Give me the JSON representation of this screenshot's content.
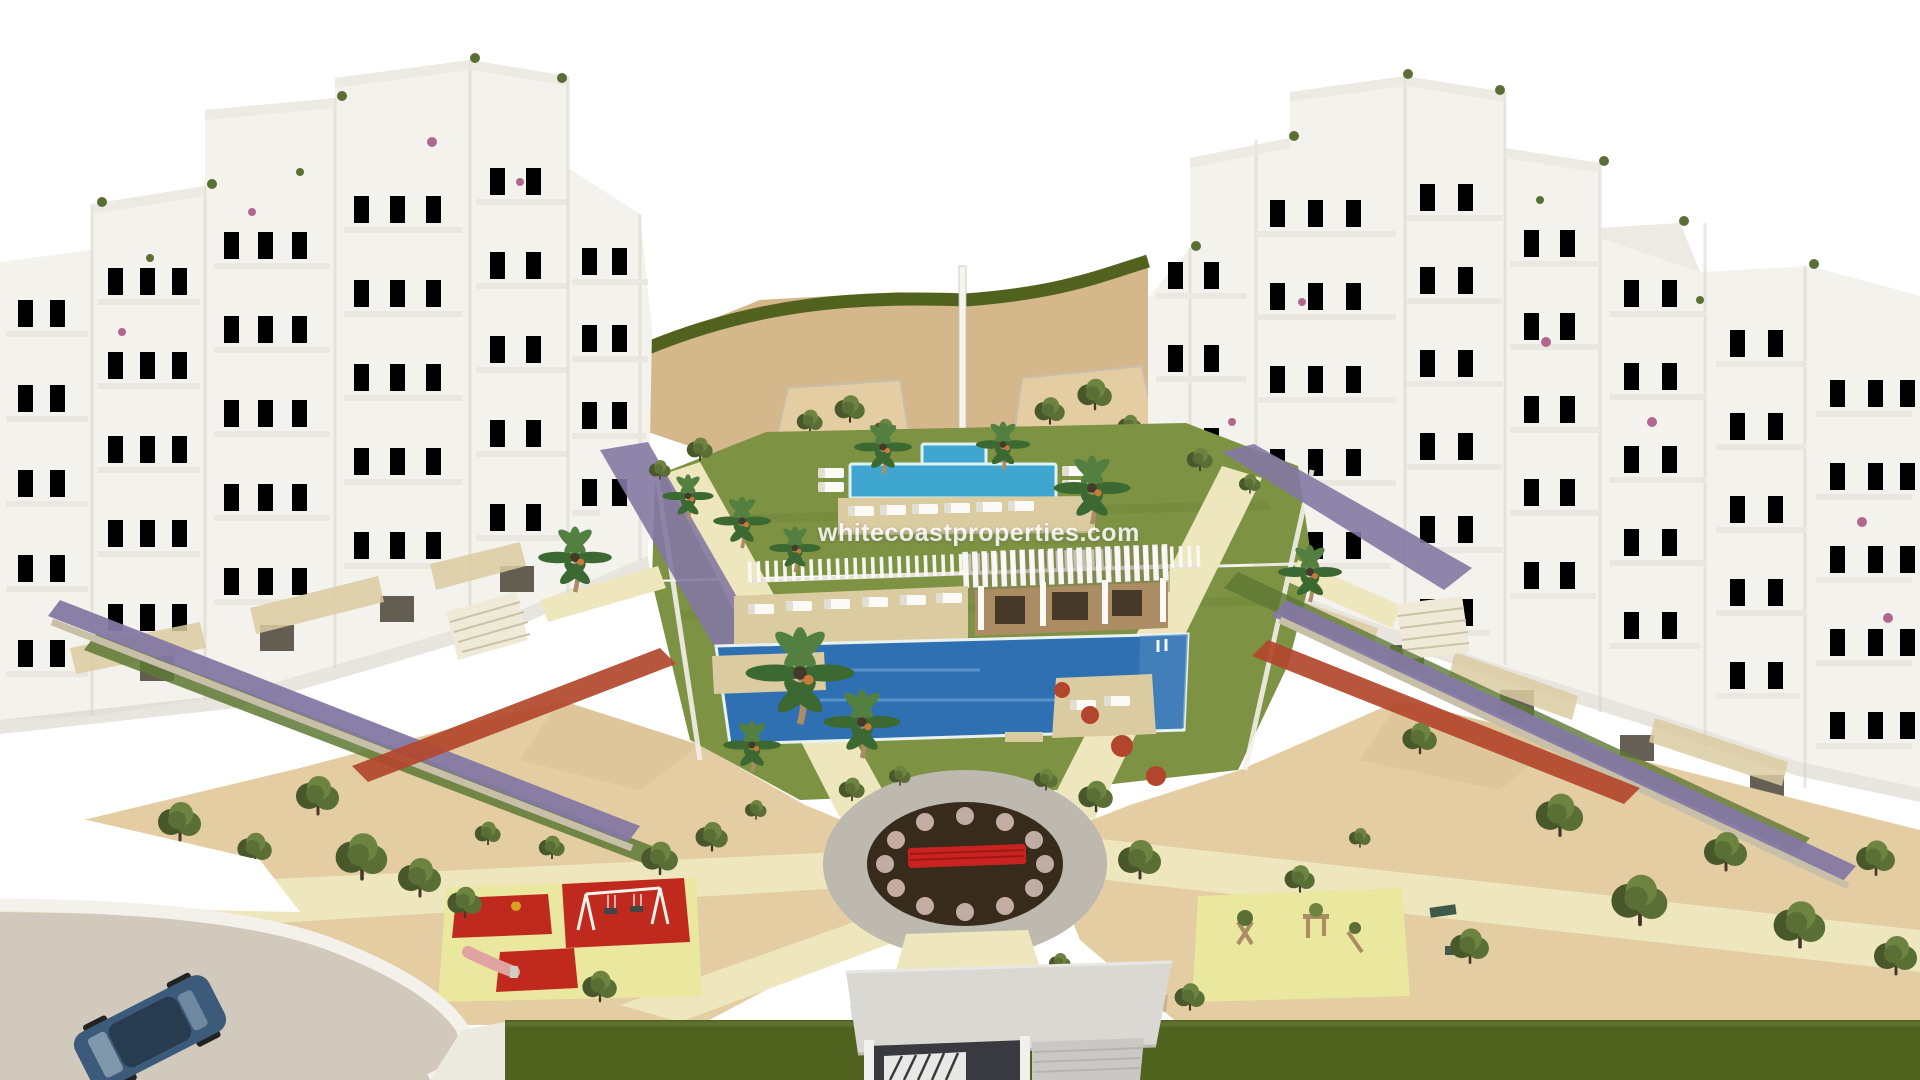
{
  "scene": {
    "watermark": "whitecoastproperties.com",
    "elements": [
      "white-apartment-blocks-left",
      "white-apartment-blocks-right",
      "sand-hill-backdrop",
      "communal-lawn",
      "upper-twin-pools",
      "pergola-pavilion",
      "main-swimming-pool",
      "sun-loungers",
      "palm-trees",
      "white-picket-fence",
      "lavender-terrace-beds",
      "red-flower-hedges",
      "circular-plaza-with-red-bench",
      "children-playground-red-mats",
      "children-playground-wooden-gym",
      "olive-trees",
      "perimeter-hedge",
      "access-road-with-car",
      "entrance-gate-ramp"
    ]
  },
  "palette": {
    "sky": "#ffffff",
    "sand_far": "#d4b78b",
    "sand_near": "#e4cda2",
    "path_cream": "#eee6bd",
    "pad_yellow": "#eae79f",
    "lawn": "#7d9243",
    "lawn_dark": "#6c8038",
    "hedge": "#51621f",
    "pool": "#2e70b2",
    "pool_upper": "#3fa7cf",
    "pool_edge": "#ddf2f4",
    "pool_shallow": "#4b86bd",
    "deck": "#dbcba1",
    "white": "#fbfaf6",
    "building": "#f3f2ec",
    "b_face": "#ffffff",
    "b_shade": "#e9e7df",
    "b_deep": "#d7d4c8",
    "window": "#4a4336",
    "wood": "#ab8c63",
    "wood_dark": "#47392a",
    "stone": "#c8bfa9",
    "lavender": "#8478a3",
    "shrub": "#5d7834",
    "flower_red": "#b2462c",
    "bougain": "#b06890",
    "tree_dark": "#49582b",
    "tree_mid": "#5a6f35",
    "tree_light": "#6d8440",
    "palm": "#3c6831",
    "palm_light": "#538040",
    "plaza_ring": "#beb9ae",
    "plaza_soil": "#372b1c",
    "plaza_shrub": "#c2ada4",
    "bench_red": "#c82320",
    "play_red": "#c02a1e",
    "slide_pink": "#dfa49f",
    "road": "#d0c9bc",
    "curb": "#f3f1ea",
    "car_body": "#3c5a7a",
    "car_dark": "#283c50",
    "car_glass": "#8fa6b8",
    "gate_roof": "#dad8d2",
    "gate_dark": "#393a3f",
    "gate_wall": "#c9c8c4"
  }
}
